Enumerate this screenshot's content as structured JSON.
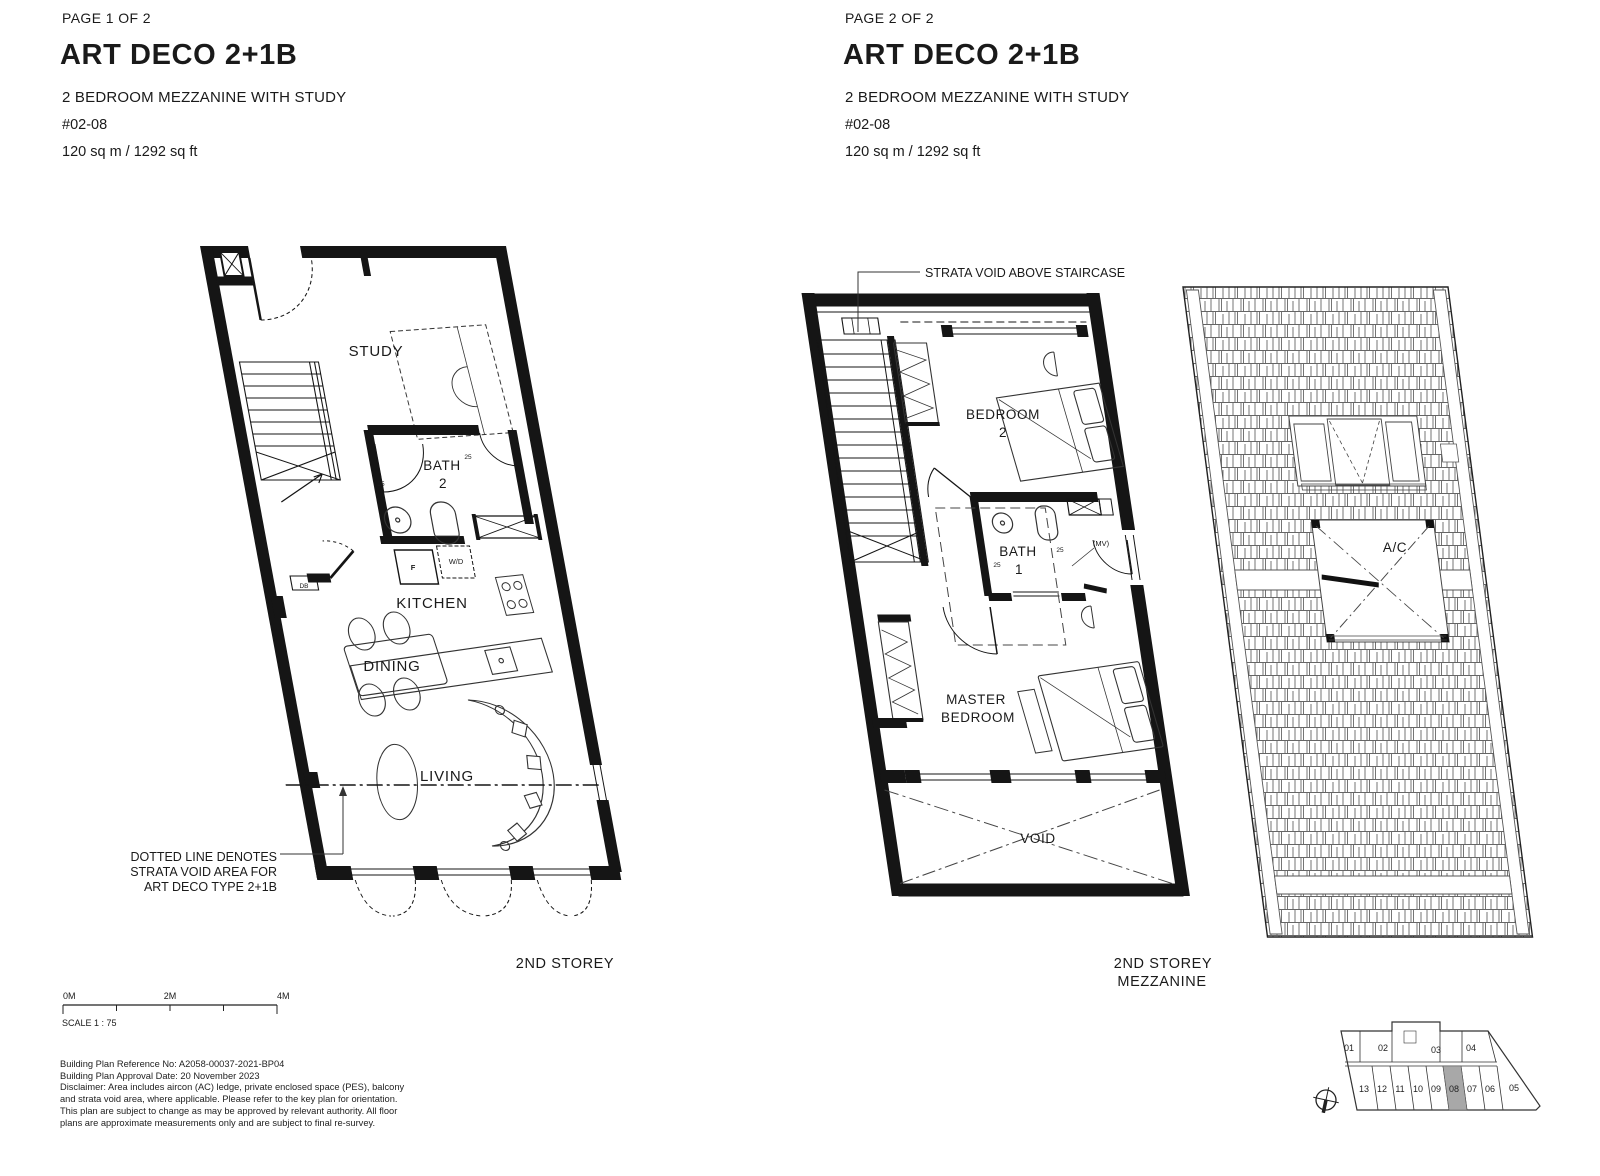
{
  "page1": {
    "page_label": "PAGE 1 OF 2",
    "title": "ART DECO 2+1B",
    "subtitle": "2 BEDROOM MEZZANINE WITH STUDY",
    "unit_no": "#02-08",
    "area": "120 sq m / 1292 sq ft",
    "storey_label": "2ND STOREY",
    "rooms": {
      "study": "STUDY",
      "bath2_l1": "BATH",
      "bath2_l2": "2",
      "kitchen": "KITCHEN",
      "dining": "DINING",
      "living": "LIVING"
    },
    "labels": {
      "fridge": "F",
      "washer": "W/D",
      "db": "DB",
      "door_l": "25",
      "door_r": "25"
    },
    "annotation": {
      "l1": "DOTTED LINE DENOTES",
      "l2": "STRATA VOID AREA FOR",
      "l3": "ART DECO TYPE 2+1B"
    },
    "scalebar": {
      "m0": "0M",
      "m2": "2M",
      "m4": "4M",
      "scale": "SCALE 1 : 75"
    },
    "notes": {
      "l1": "Building Plan Reference No: A2058-00037-2021-BP04",
      "l2": "Building Plan Approval Date: 20 November 2023",
      "l3": "Disclaimer: Area includes aircon (AC) ledge, private enclosed space (PES), balcony",
      "l4": "and strata void area, where applicable. Please refer to the key plan for orientation.",
      "l5": "This plan are subject to change as may be approved by relevant authority. All floor",
      "l6": "plans are approximate measurements only and are subject to final re-survey."
    }
  },
  "page2": {
    "page_label": "PAGE 2 OF 2",
    "title": "ART DECO 2+1B",
    "subtitle": "2 BEDROOM MEZZANINE WITH STUDY",
    "unit_no": "#02-08",
    "area": "120 sq m / 1292 sq ft",
    "storey_label_l1": "2ND STOREY",
    "storey_label_l2": "MEZZANINE",
    "annotation": "STRATA VOID ABOVE STAIRCASE",
    "rooms": {
      "bedroom2_l1": "BEDROOM",
      "bedroom2_l2": "2",
      "bath1_l1": "BATH",
      "bath1_l2": "1",
      "master_l1": "MASTER",
      "master_l2": "BEDROOM",
      "void": "VOID",
      "mv": "(MV)",
      "ac": "A/C"
    },
    "labels": {
      "door_l": "25",
      "door_r": "25"
    },
    "keyplan": {
      "top_units": [
        "01",
        "02",
        "03",
        "04"
      ],
      "bottom_units": [
        "13",
        "12",
        "11",
        "10",
        "09",
        "08",
        "07",
        "06",
        "05"
      ],
      "highlighted": "08",
      "highlight_color": "#a8a8a8"
    }
  }
}
